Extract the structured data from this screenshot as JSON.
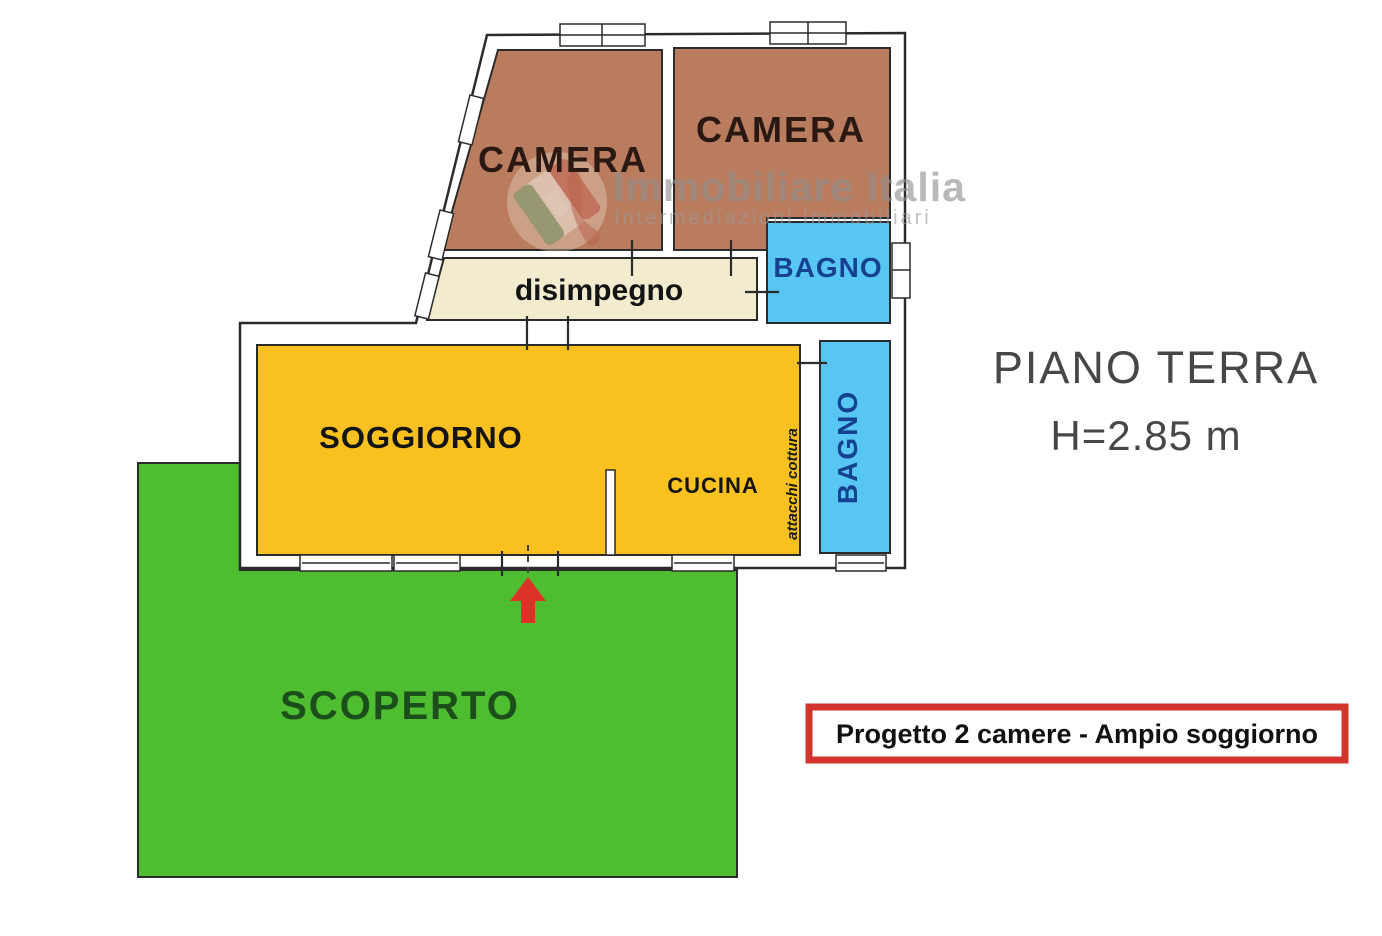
{
  "labels": {
    "camera_left": "CAMERA",
    "camera_right": "CAMERA",
    "bagno_top": "BAGNO",
    "bagno_right": "BAGNO",
    "disimpegno": "disimpegno",
    "soggiorno": "SOGGIORNO",
    "cucina": "CUCINA",
    "scoperto": "SCOPERTO",
    "attacchi_cottura": "attacchi cottura"
  },
  "titles": {
    "floor": "PIANO TERRA",
    "height": "H=2.85 m",
    "project": "Progetto 2 camere - Ampio soggiorno"
  },
  "watermark": {
    "name": "Immobiliare Italia",
    "tagline": "Intermediazioni immobiliari"
  },
  "colors": {
    "camera": "#ba7c5e",
    "bagno": "#58c6f2",
    "disimpegno": "#f2ebce",
    "soggiorno": "#f8c120",
    "scoperto": "#4ebd2f",
    "red_accent": "#dd3227",
    "bagno_text": "#15418f",
    "scoperto_text": "#1c4e1c",
    "floor_text": "#474747",
    "wall_line": "#2b2b2b"
  }
}
